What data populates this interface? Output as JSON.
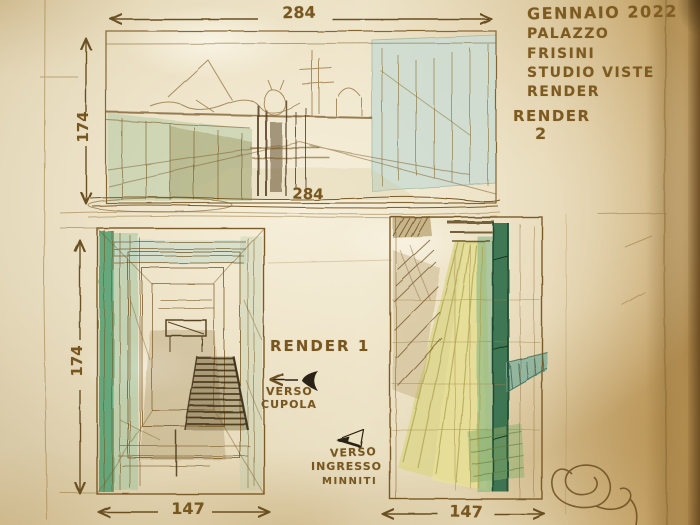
{
  "title_block": {
    "line1": "GENNAIO 2022",
    "line2": "PALAZZO",
    "line3": "FRISINI",
    "line4": "STUDIO VISTE",
    "line5": "RENDER",
    "render_label": "RENDER",
    "render_number": "2"
  },
  "dimensions": {
    "top_width": "284",
    "top_width_inner": "284",
    "top_height": "174",
    "bottom_height": "174",
    "bottom_left_width": "147",
    "bottom_right_width": "147"
  },
  "annotations": {
    "render1_label": "RENDER 1",
    "verso_cupola_line1": "VERSO",
    "verso_cupola_line2": "CUPOLA",
    "verso_ingresso_line1": "VERSO",
    "verso_ingresso_line2": "INGRESSO",
    "verso_ingresso_line3": "MINNITI"
  },
  "symbols": {
    "left_arrow": "←",
    "view_marker": "◄"
  },
  "colors": {
    "ink": "#7a5a26",
    "ink_dark": "#45351a",
    "wash_green": "#58a173",
    "wash_teal": "#ccdcd2",
    "wash_yellow": "#ddd68c",
    "paper_light": "#e9dfc4",
    "paper_dark": "#a8824a"
  }
}
